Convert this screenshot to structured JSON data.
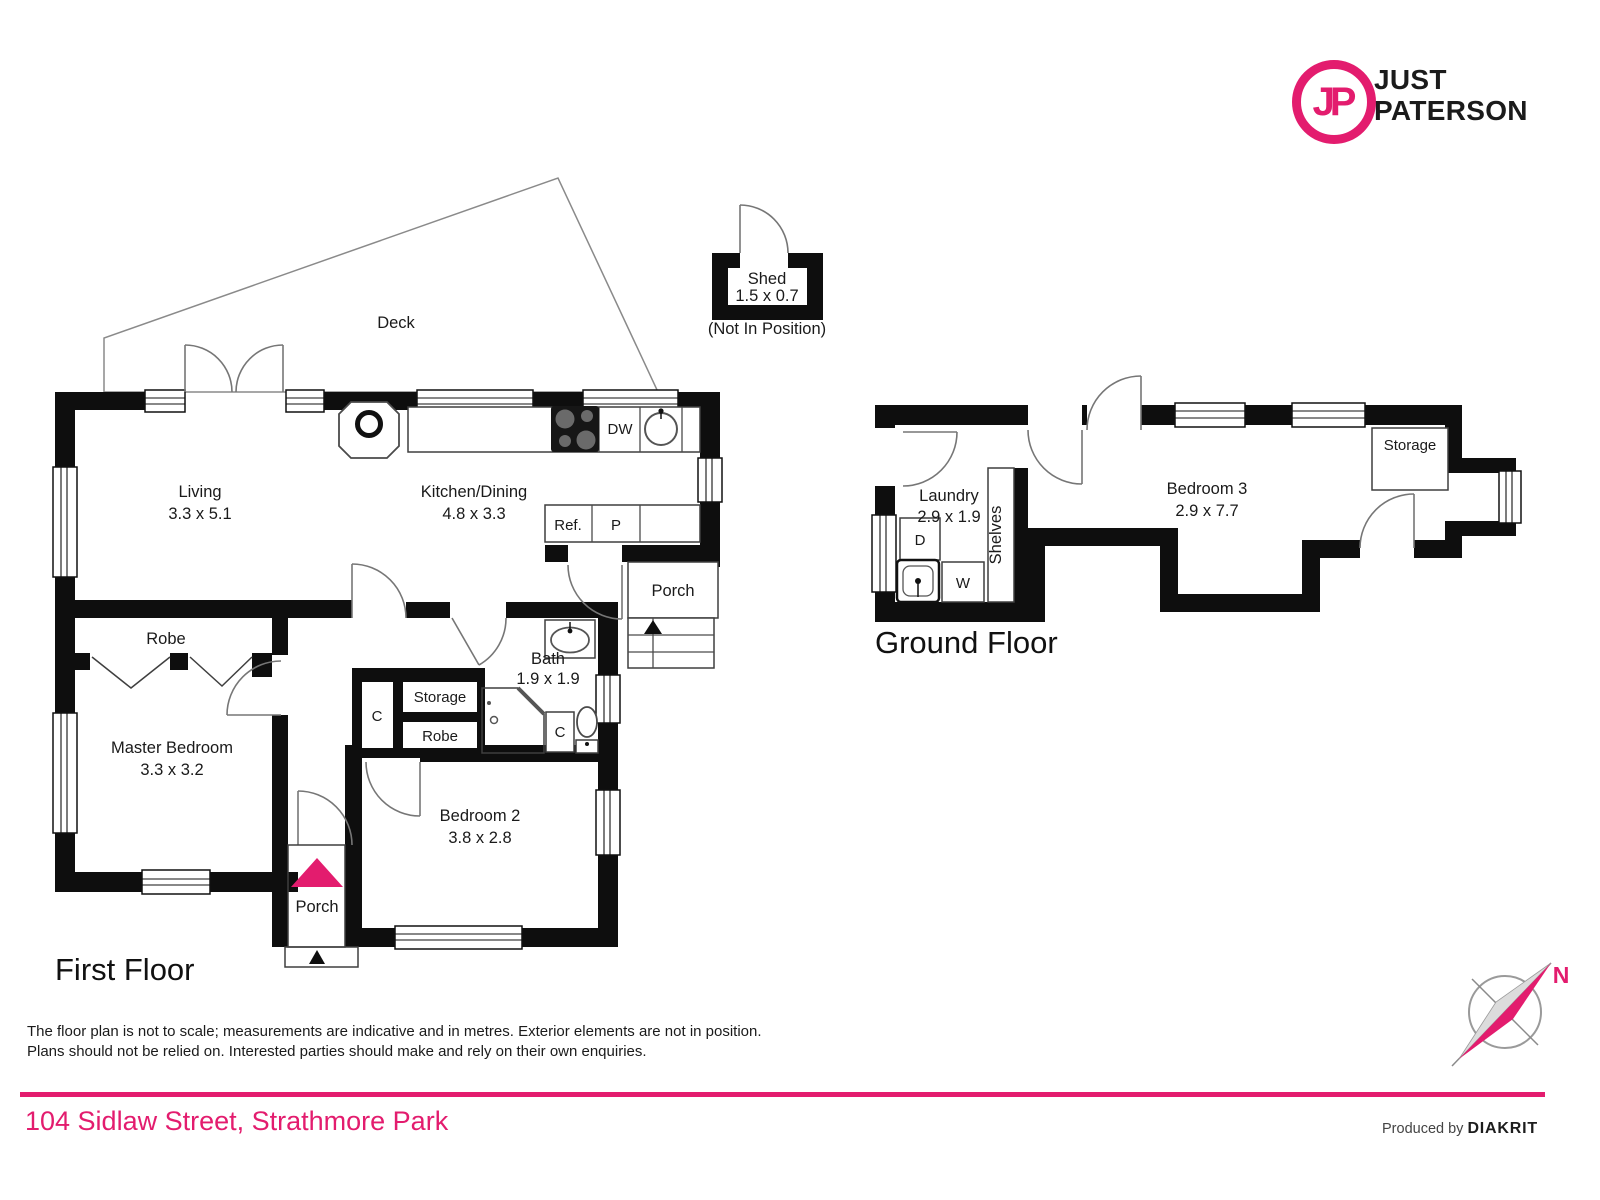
{
  "logo": {
    "monogram": "JP",
    "line1": "JUST",
    "line2": "PATERSON"
  },
  "colors": {
    "accent": "#e31c6e"
  },
  "first_floor": {
    "title": "First Floor",
    "deck": "Deck",
    "shed": {
      "name": "Shed",
      "dims": "1.5 x 0.7",
      "note": "(Not In Position)"
    },
    "living": {
      "name": "Living",
      "dims": "3.3 x 5.1"
    },
    "kitchen": {
      "name": "Kitchen/Dining",
      "dims": "4.8 x 3.3"
    },
    "master": {
      "name": "Master Bedroom",
      "dims": "3.3 x 3.2"
    },
    "bedroom2": {
      "name": "Bedroom 2",
      "dims": "3.8 x 2.8"
    },
    "bath": {
      "name": "Bath",
      "dims": "1.9 x 1.9"
    },
    "robe_master": "Robe",
    "robe_hall": "Robe",
    "storage": "Storage",
    "cupboard_left": "C",
    "cupboard_bath": "C",
    "porch_side": "Porch",
    "porch_front": "Porch",
    "appliances": {
      "dw": "DW",
      "fridge": "Ref.",
      "pantry": "P"
    }
  },
  "ground_floor": {
    "title": "Ground Floor",
    "laundry": {
      "name": "Laundry",
      "dims": "2.9 x 1.9"
    },
    "bedroom3": {
      "name": "Bedroom 3",
      "dims": "2.9 x 7.7"
    },
    "storage": "Storage",
    "shelves": "Shelves",
    "dryer": "D",
    "washer": "W"
  },
  "compass": {
    "north": "N"
  },
  "footer": {
    "disclaimer1": "The floor plan is not to scale; measurements are indicative and in metres. Exterior elements are not in position.",
    "disclaimer2": "Plans should not be relied on. Interested parties should make and rely on their own enquiries.",
    "address": "104 Sidlaw Street, Strathmore Park",
    "produced_by": "Produced by",
    "producer": "DIAKRIT"
  }
}
